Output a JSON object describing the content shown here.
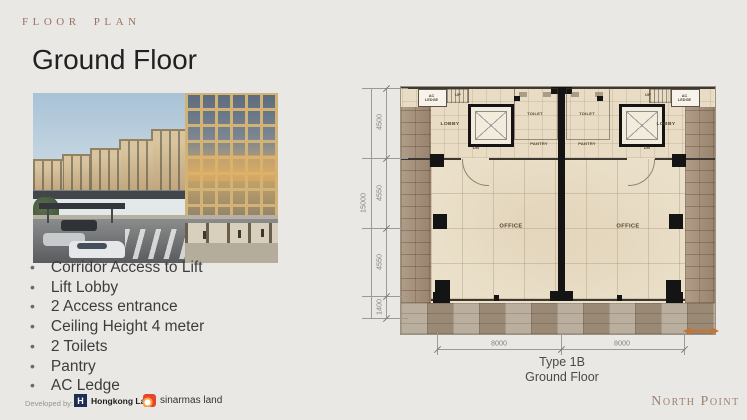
{
  "slide": {
    "eyebrow": "FLOOR PLAN",
    "title": "Ground Floor",
    "bullets": [
      "Corridor Access to Lift",
      "Lift Lobby",
      "2 Access entrance",
      "Ceiling Height 4 meter",
      "2 Toilets",
      "Pantry",
      "AC Ledge"
    ],
    "footer": {
      "developed_by": "Developed by:",
      "hkl_monogram": "H",
      "logo_hongkong_land": "Hongkong Land",
      "logo_sinarmas": "sinarmas land",
      "brand": "North Point"
    }
  },
  "floor_plan": {
    "caption": {
      "type": "Type 1B",
      "floor": "Ground Floor"
    },
    "labels": {
      "lobby": "LOBBY",
      "toilet": "TOILET",
      "pantry": "PANTRY",
      "office": "OFFICE",
      "dn": "DN",
      "up": "UP",
      "ac_ledge": "AC LEDGE"
    },
    "dimensions": {
      "vertical": [
        "4500",
        "4550",
        "4550",
        "1400"
      ],
      "vertical_total": "15000",
      "horizontal": [
        "8000",
        "8000"
      ]
    },
    "colors": {
      "floor": "#ece2cc",
      "stone": "#a58f77",
      "wall": "#141414",
      "dimension": "#9a9a9a",
      "entrance_arrow": "#c0763b",
      "accent_serif": "#9a7263"
    }
  }
}
